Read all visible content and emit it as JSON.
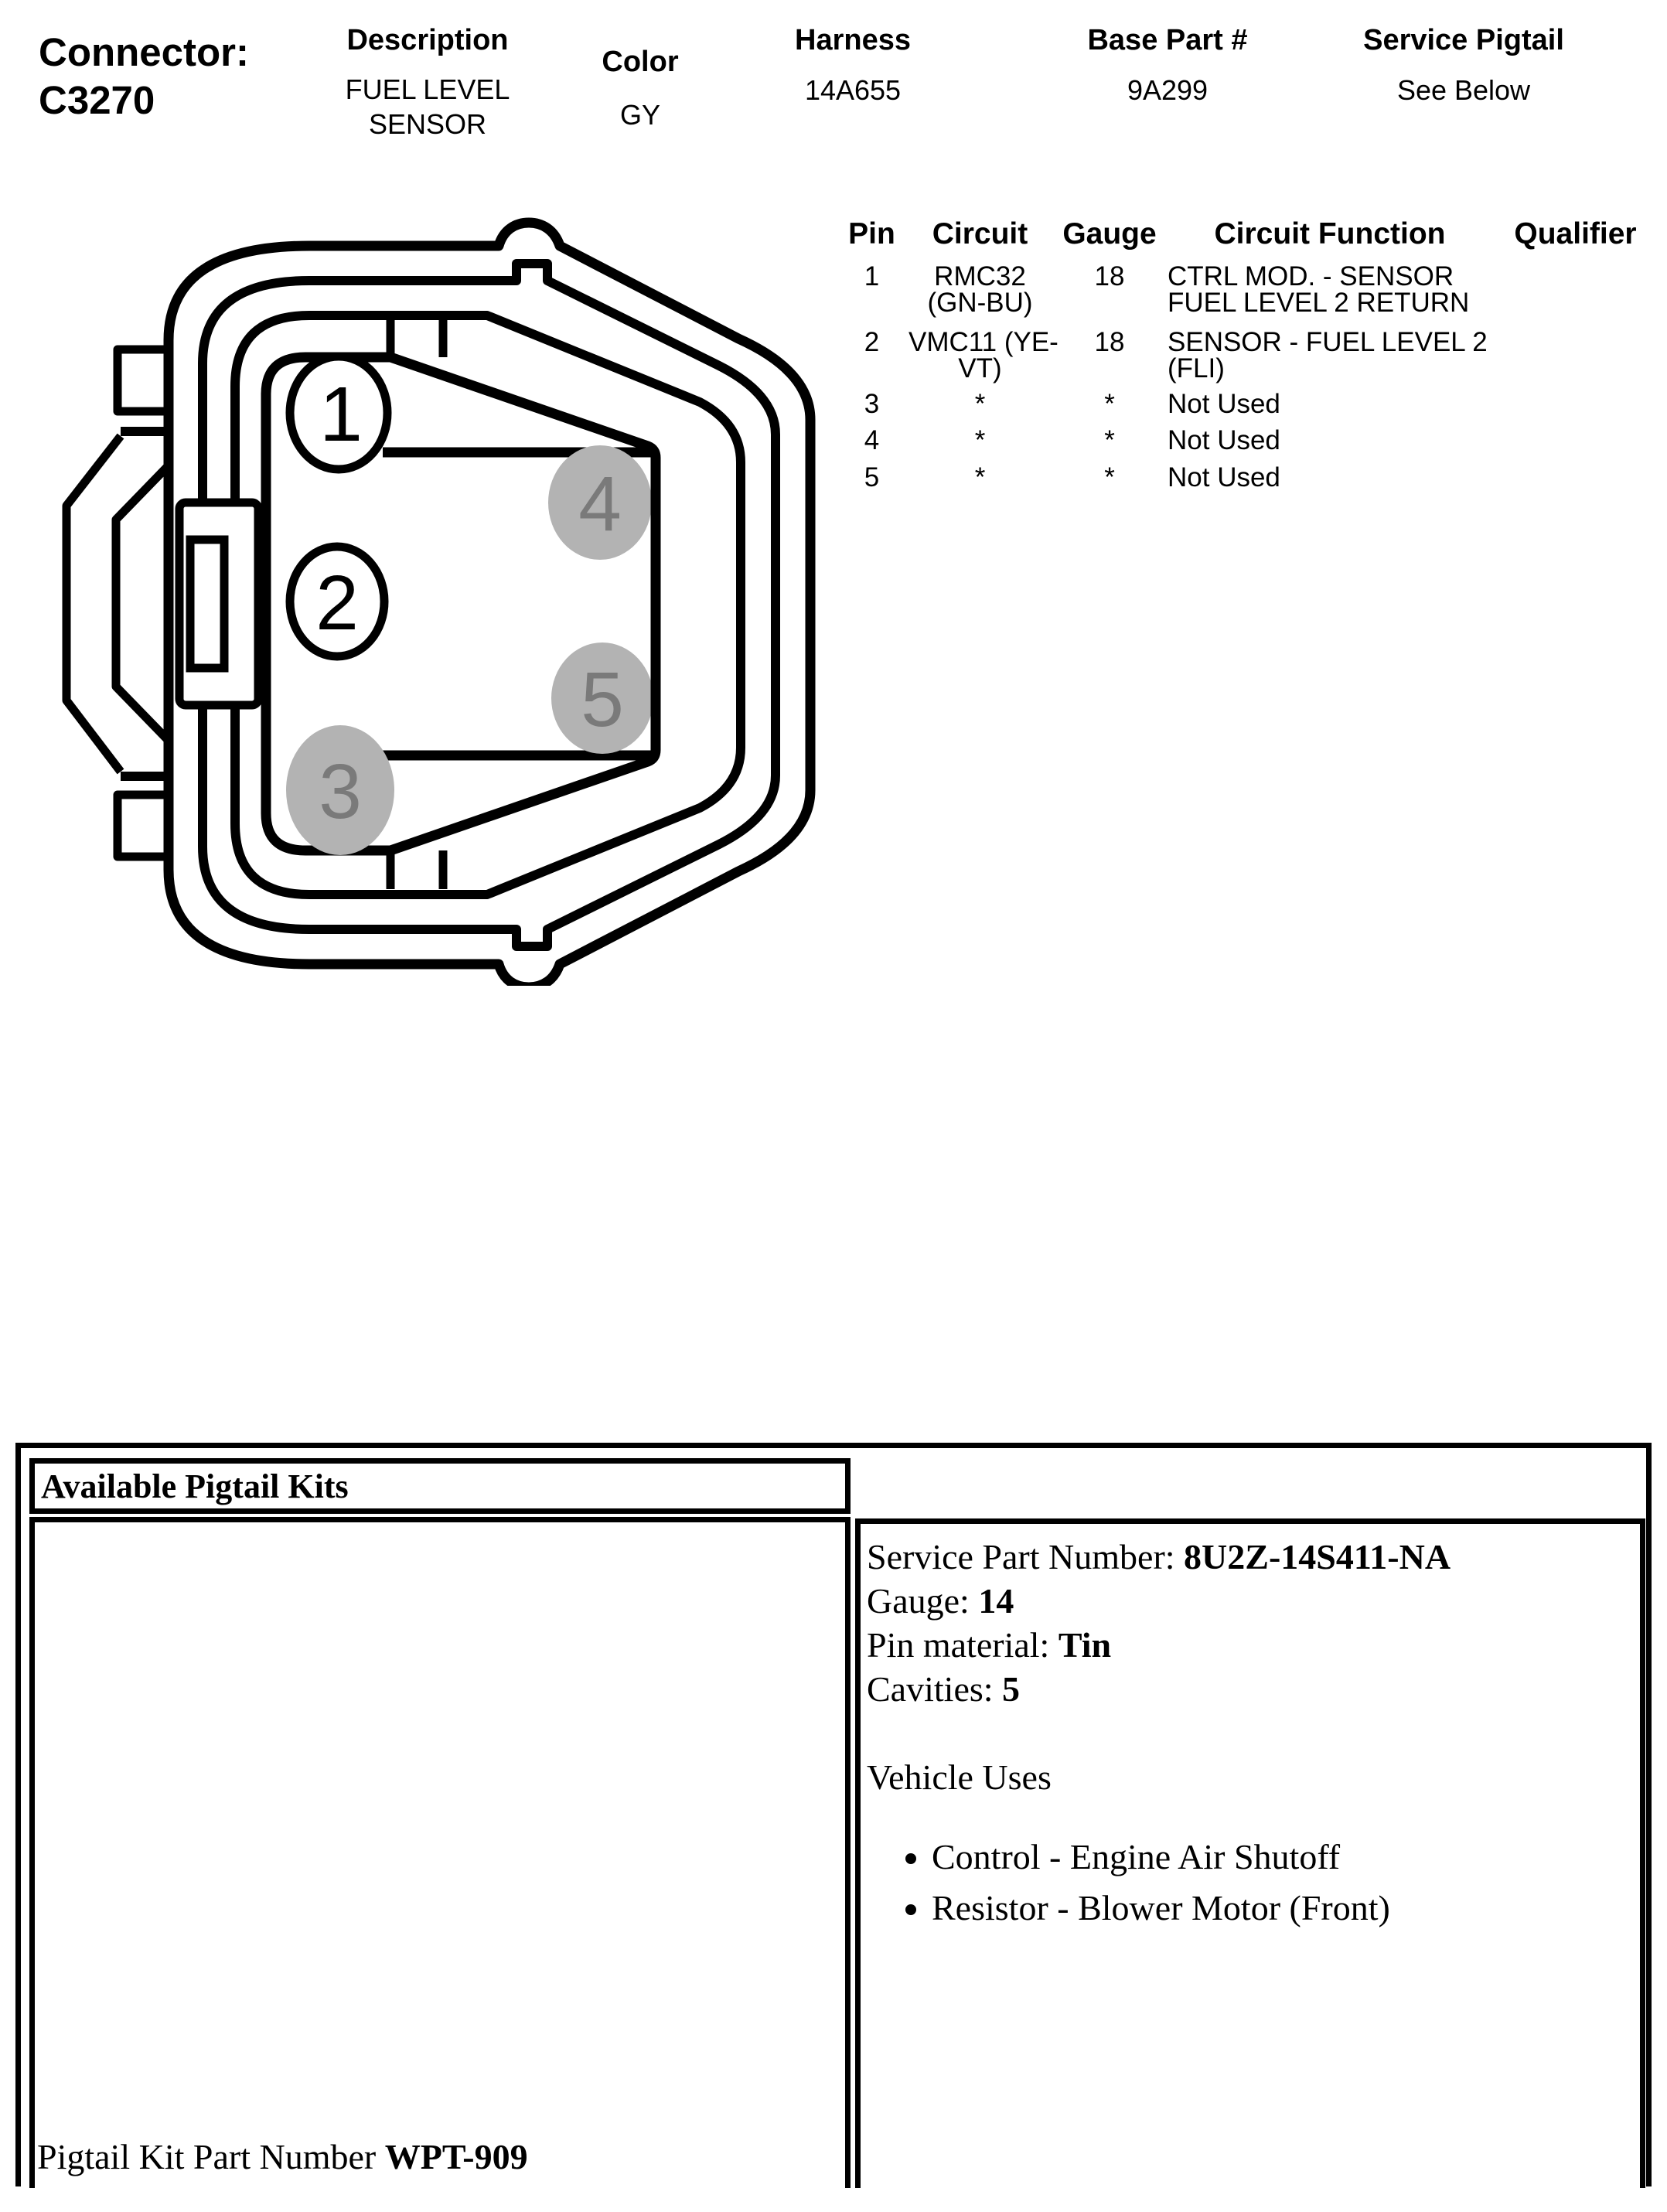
{
  "header": {
    "connector_label": "Connector:",
    "connector_id": "C3270",
    "description": {
      "label": "Description",
      "line1": "FUEL LEVEL",
      "line2": "SENSOR"
    },
    "color": {
      "label": "Color",
      "value": "GY"
    },
    "harness": {
      "label": "Harness",
      "value": "14A655"
    },
    "base_part": {
      "label": "Base Part #",
      "value": "9A299"
    },
    "service_pigtail": {
      "label": "Service Pigtail",
      "value": "See Below"
    }
  },
  "pin_table": {
    "headers": {
      "pin": "Pin",
      "circuit": "Circuit",
      "gauge": "Gauge",
      "function": "Circuit Function",
      "qualifier": "Qualifier"
    },
    "rows": [
      {
        "pin": "1",
        "circuit_l1": "RMC32",
        "circuit_l2": "(GN-BU)",
        "gauge": "18",
        "function_l1": "CTRL MOD. - SENSOR",
        "function_l2": "FUEL LEVEL 2 RETURN",
        "qualifier": ""
      },
      {
        "pin": "2",
        "circuit_l1": "VMC11 (YE-",
        "circuit_l2": "VT)",
        "gauge": "18",
        "function_l1": "SENSOR - FUEL LEVEL 2",
        "function_l2": "(FLI)",
        "qualifier": ""
      },
      {
        "pin": "3",
        "circuit_l1": "*",
        "circuit_l2": "",
        "gauge": "*",
        "function_l1": "Not Used",
        "function_l2": "",
        "qualifier": ""
      },
      {
        "pin": "4",
        "circuit_l1": "*",
        "circuit_l2": "",
        "gauge": "*",
        "function_l1": "Not Used",
        "function_l2": "",
        "qualifier": ""
      },
      {
        "pin": "5",
        "circuit_l1": "*",
        "circuit_l2": "",
        "gauge": "*",
        "function_l1": "Not Used",
        "function_l2": "",
        "qualifier": ""
      }
    ]
  },
  "diagram": {
    "pins": [
      {
        "number": "1",
        "style": "open"
      },
      {
        "number": "2",
        "style": "open"
      },
      {
        "number": "3",
        "style": "filled"
      },
      {
        "number": "4",
        "style": "filled"
      },
      {
        "number": "5",
        "style": "filled"
      }
    ],
    "colors": {
      "outline": "#000000",
      "open_pin_fill": "#ffffff",
      "open_pin_number": "#000000",
      "filled_pin": "#b3b3b3",
      "filled_pin_number": "#7a7a7a"
    }
  },
  "pigtail_kits": {
    "title": "Available Pigtail Kits",
    "service_part": {
      "label": "Service Part Number:",
      "value": "8U2Z-14S411-NA"
    },
    "gauge": {
      "label": "Gauge:",
      "value": "14"
    },
    "pin_material": {
      "label": "Pin material:",
      "value": "Tin"
    },
    "cavities": {
      "label": "Cavities:",
      "value": "5"
    },
    "vehicle_uses_title": "Vehicle Uses",
    "vehicle_uses": [
      "Control - Engine Air Shutoff",
      "Resistor - Blower Motor (Front)"
    ],
    "kit_number": {
      "label": "Pigtail Kit Part Number",
      "value": "WPT-909"
    }
  }
}
